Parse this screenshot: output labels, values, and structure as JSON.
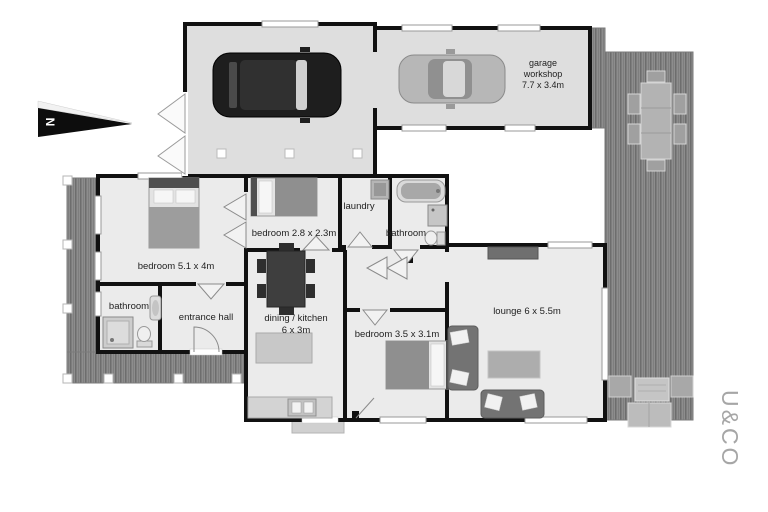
{
  "compass": {
    "label": "N"
  },
  "watermark": {
    "label": "U&CO"
  },
  "rooms": {
    "garage": {
      "lines": [
        "garage",
        "workshop",
        "7.7 x 3.4m"
      ]
    },
    "bedroom_main": {
      "label": "bedroom 5.1 x 4m"
    },
    "bedroom_small": {
      "label": "bedroom 2.8 x 2.3m"
    },
    "laundry": {
      "label": "laundry"
    },
    "bathroom_main": {
      "label": "bathroom"
    },
    "bathroom_left": {
      "label": "bathroom"
    },
    "entrance_hall": {
      "label": "entrance hall"
    },
    "dining_kitchen": {
      "lines": [
        "dining / kitchen",
        "6 x 3m"
      ]
    },
    "bedroom_third": {
      "label": "bedroom 3.5 x 3.1m"
    },
    "lounge": {
      "label": "lounge 6 x 5.5m"
    }
  },
  "colors": {
    "wall": "#111111",
    "room_fill": "#ebebeb",
    "garage_fill": "#dedede",
    "deck_base": "#8d8d8d",
    "deck_stripe": "#6d6d6d",
    "background": "#ffffff",
    "watermark_gray": "#a6a6a6"
  }
}
